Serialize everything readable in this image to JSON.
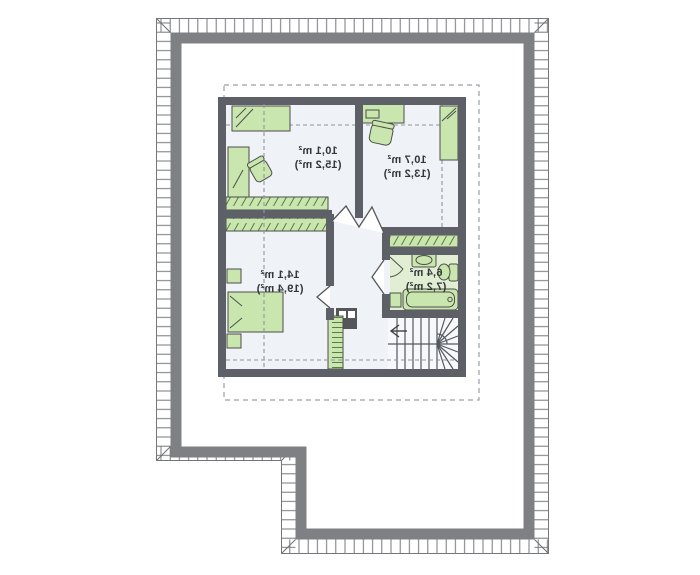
{
  "plan": {
    "rooms": [
      {
        "key": "bedroom-top-left",
        "area": "10,1 m²",
        "area_gross": "(15,2 m²)"
      },
      {
        "key": "bedroom-top-right",
        "area": "10,7 m²",
        "area_gross": "(13,2 m²)"
      },
      {
        "key": "bedroom-bottom-left",
        "area": "14,1 m²",
        "area_gross": "(19,4 m²)"
      },
      {
        "key": "bathroom",
        "area": "6,4 m²",
        "area_gross": "(7,2 m²)"
      }
    ],
    "colors": {
      "furniture_green": "#c9e6ae",
      "bathroom_floor": "#e2eed4",
      "floor": "#eff2f7",
      "inner_wall": "#5d6066",
      "roof_outline": "#7e8084",
      "hatch_tick": "#74767a",
      "dashed_line": "#9aa0a8",
      "label_text": "#33363a"
    }
  }
}
